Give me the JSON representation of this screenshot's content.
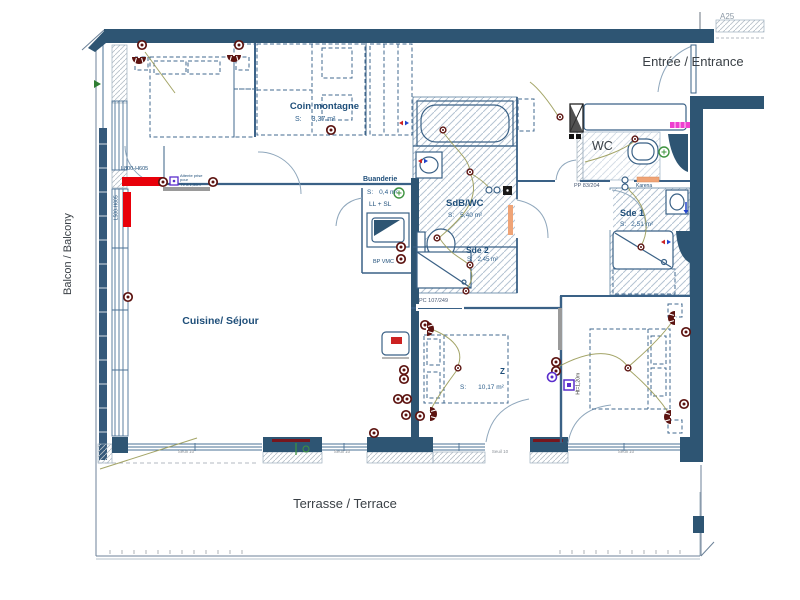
{
  "colors": {
    "wall": "#2e5573",
    "wall_line": "#3a6186",
    "label_navy": "#1e4e79",
    "text_dark": "#3a4046",
    "radiator_red": "#e8000a",
    "symbol_maroon": "#5c1310",
    "towel_magenta": "#ee3fd0",
    "karena_orange": "#efa477",
    "wiring_olive": "#9a9b57",
    "marker_purple": "#5a2ecc",
    "marker_green": "#3f9440"
  },
  "labels": {
    "a25": "A25",
    "entrance": "Entrée / Entrance",
    "balcony": "Balcon / Balcony",
    "terrace": "Terrasse / Terrace",
    "wc": "WC",
    "z_marker": "Z",
    "threshold": "Seuil 10",
    "pp_door": "PP 83/204",
    "pc_door": "PC 107/249",
    "karena": "Karena",
    "radiator_h": "L800-H605",
    "radiator_v": "L500-H605",
    "bp_vmc": "BP VMC",
    "height_note": "Ht=1,20m",
    "tv_note_line1": "Attente prise pour",
    "tv_note_line2": "TV à 1,30m"
  },
  "rooms": {
    "living": {
      "name": "Cuisine/ Séjour"
    },
    "coin": {
      "name": "Coin montagne",
      "s": "S:",
      "area": "3,37 m²"
    },
    "buanderie": {
      "name": "Buanderie",
      "s": "S:",
      "area": "0,4 m²",
      "appliances": "LL + SL"
    },
    "sdb": {
      "name": "SdB/WC",
      "s": "S:",
      "area": "5,40 m²"
    },
    "sde2": {
      "name": "Sde 2",
      "s": "S:",
      "area": "2,45 m²"
    },
    "sde1": {
      "name": "Sde 1",
      "s": "S:",
      "area": "2,51 m²"
    },
    "bedroom": {
      "s": "S:",
      "area": "10,17 m²"
    }
  }
}
